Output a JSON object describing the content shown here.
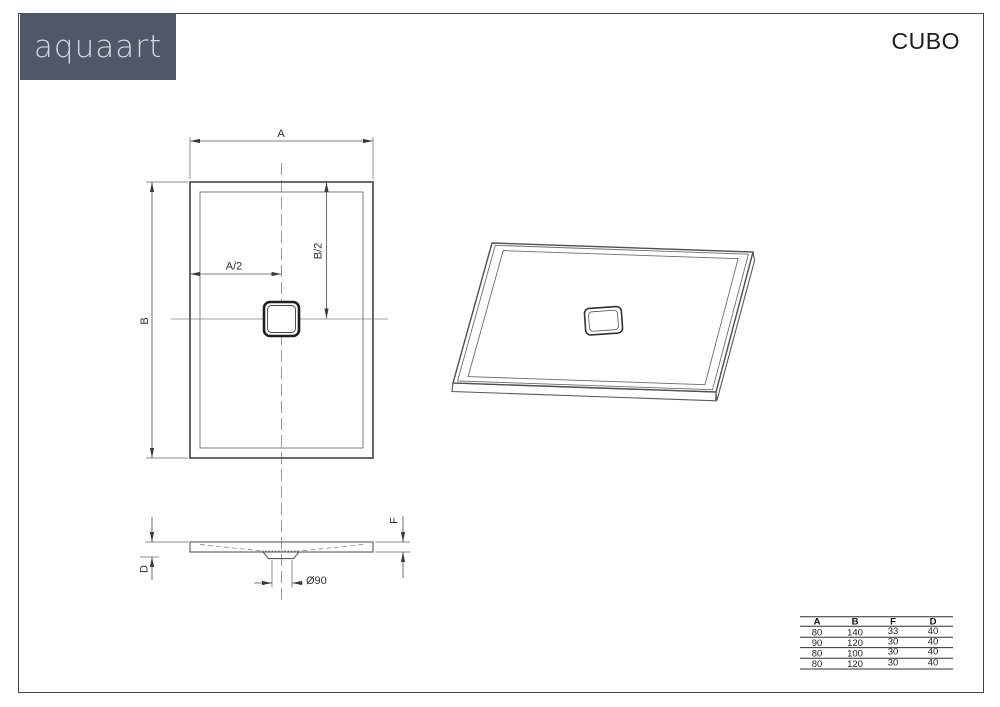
{
  "page": {
    "title": "CUBO"
  },
  "brand": {
    "logo_text": "aquaart"
  },
  "colors": {
    "logo_bg": "#4e5869",
    "logo_text_color": "#d7dadd",
    "line": "#55595e"
  },
  "drawing": {
    "top_view": {
      "dim_width": "A",
      "dim_height": "B",
      "dim_center_x": "A/2",
      "dim_center_y": "B/2"
    },
    "section_view": {
      "dim_edge_height": "F",
      "dim_total_height": "D",
      "dim_drain": "Ø90"
    }
  },
  "size_table": {
    "headers": [
      "A",
      "B",
      "F",
      "D"
    ],
    "rows": [
      [
        "80",
        "140",
        "33",
        "40"
      ],
      [
        "90",
        "120",
        "30",
        "40"
      ],
      [
        "80",
        "100",
        "30",
        "40"
      ],
      [
        "80",
        "120",
        "30",
        "40"
      ]
    ]
  }
}
